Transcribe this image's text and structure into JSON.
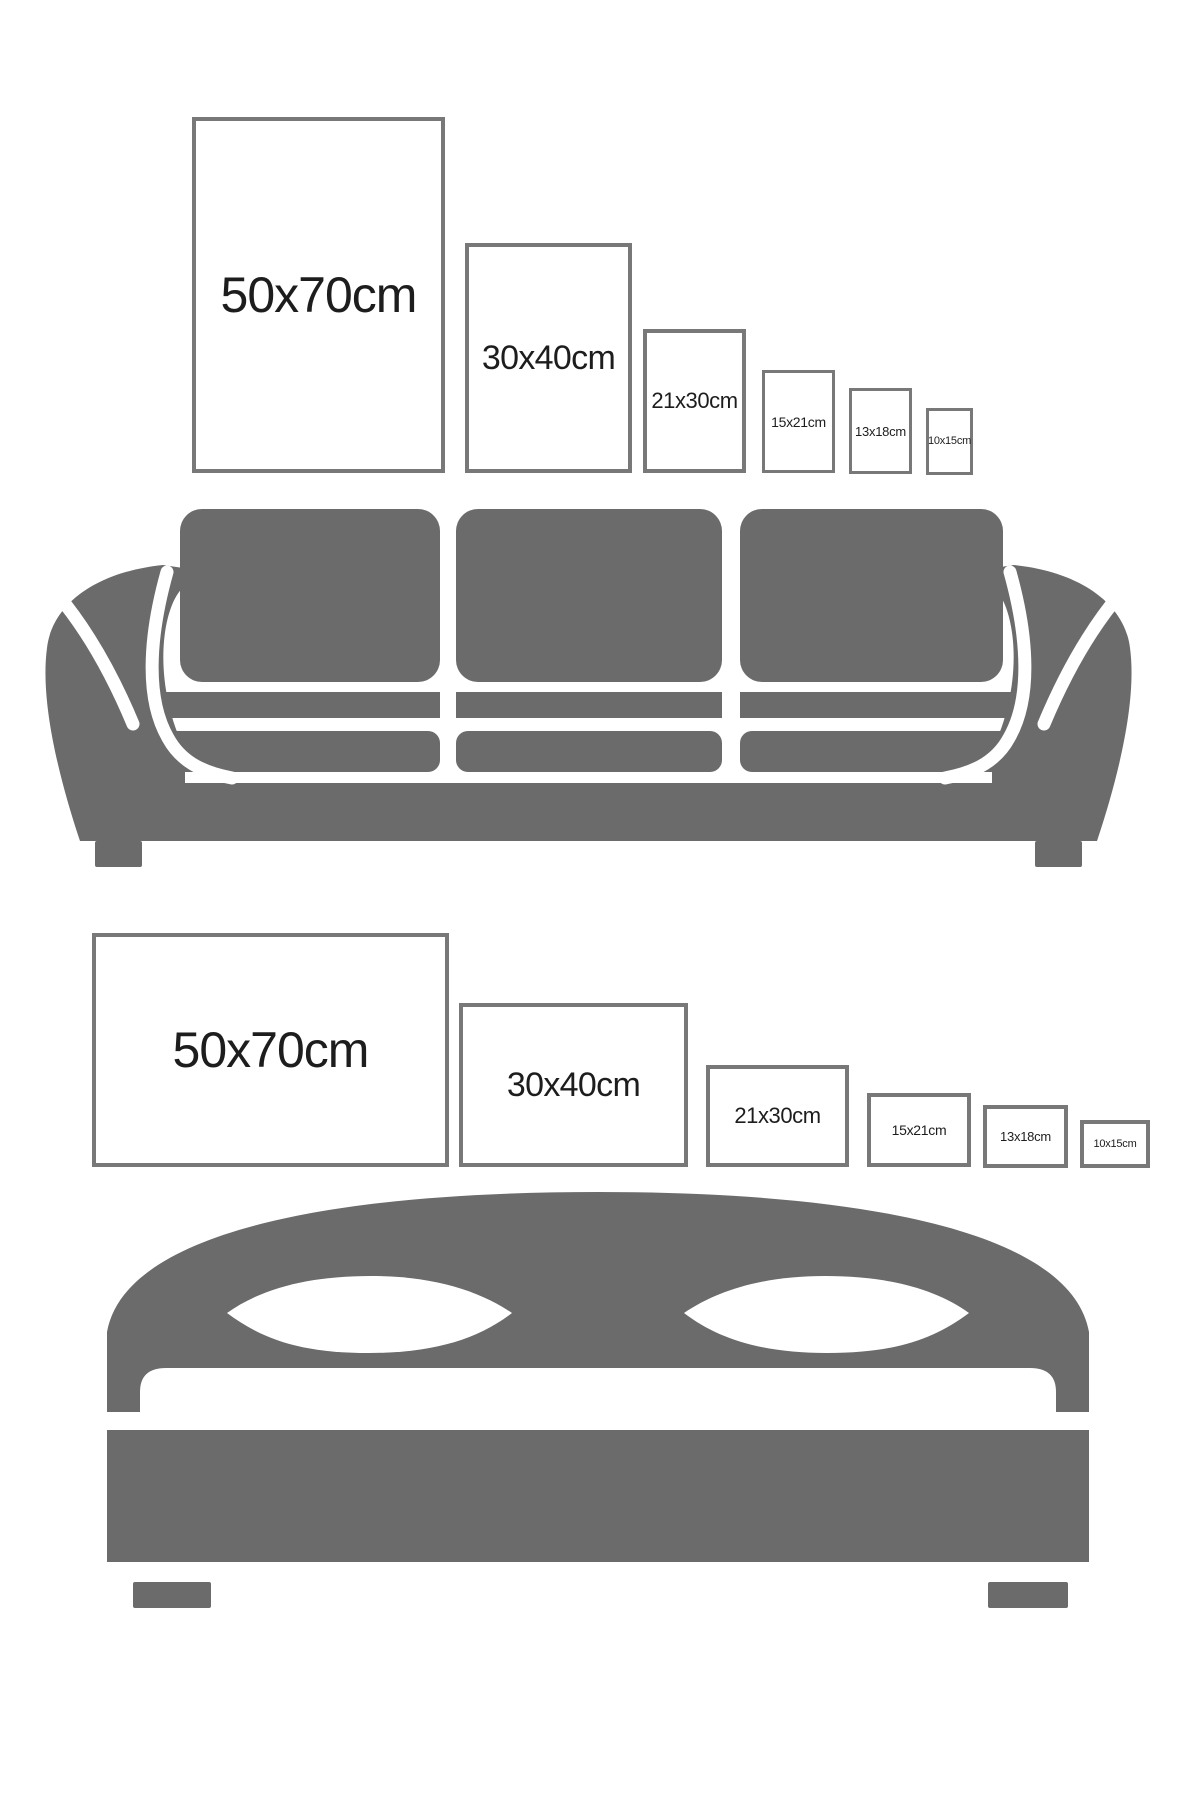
{
  "image": {
    "kind": "poster-size-comparison-guide",
    "rows": 2
  },
  "colors": {
    "furniture": "#6b6b6b",
    "frame_border": "#787878",
    "label_text": "#1d1d1d",
    "background": "#ffffff"
  },
  "sofa_row": {
    "furniture_icon": "sofa-silhouette",
    "orientation": "portrait",
    "frames": [
      {
        "label": "50x70cm"
      },
      {
        "label": "30x40cm"
      },
      {
        "label": "21x30cm"
      },
      {
        "label": "15x21cm"
      },
      {
        "label": "13x18cm"
      },
      {
        "label": "10x15cm"
      }
    ]
  },
  "bed_row": {
    "furniture_icon": "bed-silhouette",
    "orientation": "landscape",
    "frames": [
      {
        "label": "50x70cm"
      },
      {
        "label": "30x40cm"
      },
      {
        "label": "21x30cm"
      },
      {
        "label": "15x21cm"
      },
      {
        "label": "13x18cm"
      },
      {
        "label": "10x15cm"
      }
    ]
  }
}
